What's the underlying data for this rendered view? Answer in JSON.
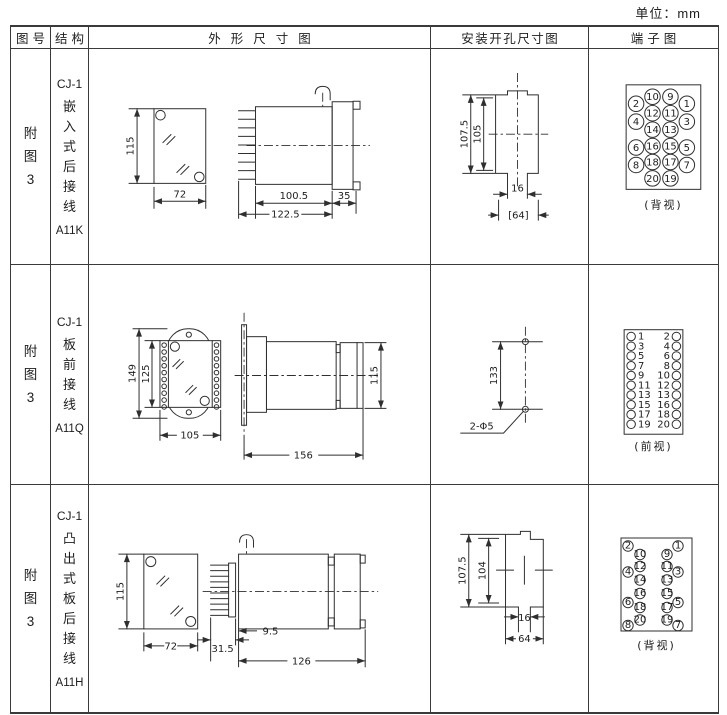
{
  "units_label": "单位：mm",
  "header": {
    "figure": "图号",
    "structure": "结构",
    "outline": "外形尺寸图",
    "mounting": "安装开孔尺寸图",
    "terminal": "端子图"
  },
  "rows": [
    {
      "figure": "附图3",
      "model": "CJ-1",
      "structure": "嵌入式后接线",
      "code": "A11K",
      "outline": {
        "front_h": "115",
        "front_w": "72",
        "d1": "100.5",
        "d2": "122.5",
        "d3": "35"
      },
      "mounting": {
        "v1": "107.5",
        "v2": "105",
        "h1": "16",
        "h2": "[64]"
      },
      "terminal": {
        "caption": "(背视)",
        "outer_left": [
          "2",
          "4",
          "6",
          "8"
        ],
        "inner_left": [
          "10",
          "12",
          "14",
          "16",
          "18",
          "20"
        ],
        "inner_right": [
          "9",
          "11",
          "13",
          "15",
          "17",
          "19"
        ],
        "outer_right": [
          "1",
          "3",
          "5",
          "7"
        ]
      }
    },
    {
      "figure": "附图3",
      "model": "CJ-1",
      "structure": "板前接线",
      "code": "A11Q",
      "outline": {
        "v1": "149",
        "v2": "125",
        "w": "105",
        "side_w": "156",
        "side_h": "115"
      },
      "mounting": {
        "v": "133",
        "hole_label": "2-Φ5"
      },
      "terminal": {
        "caption": "(前视)",
        "left": [
          "1",
          "3",
          "5",
          "7",
          "9",
          "11",
          "13",
          "15",
          "17",
          "19"
        ],
        "right": [
          "2",
          "4",
          "6",
          "8",
          "10",
          "12",
          "13",
          "16",
          "18",
          "20"
        ]
      }
    },
    {
      "figure": "附图3",
      "model": "CJ-1",
      "structure": "凸出式板后接线",
      "code": "A11H",
      "outline": {
        "front_h": "115",
        "front_w": "72",
        "d1": "31.5",
        "d2": "9.5",
        "d3": "126"
      },
      "mounting": {
        "v1": "107.5",
        "v2": "104",
        "h1": "16",
        "h2": "64"
      },
      "terminal": {
        "caption": "(背视)",
        "outer_left": [
          "2",
          "4",
          "6",
          "8"
        ],
        "inner_left": [
          "10",
          "12",
          "14",
          "16",
          "18",
          "20"
        ],
        "inner_right": [
          "9",
          "11",
          "13",
          "15",
          "17",
          "19"
        ],
        "outer_right": [
          "1",
          "3",
          "5",
          "7"
        ]
      }
    }
  ]
}
